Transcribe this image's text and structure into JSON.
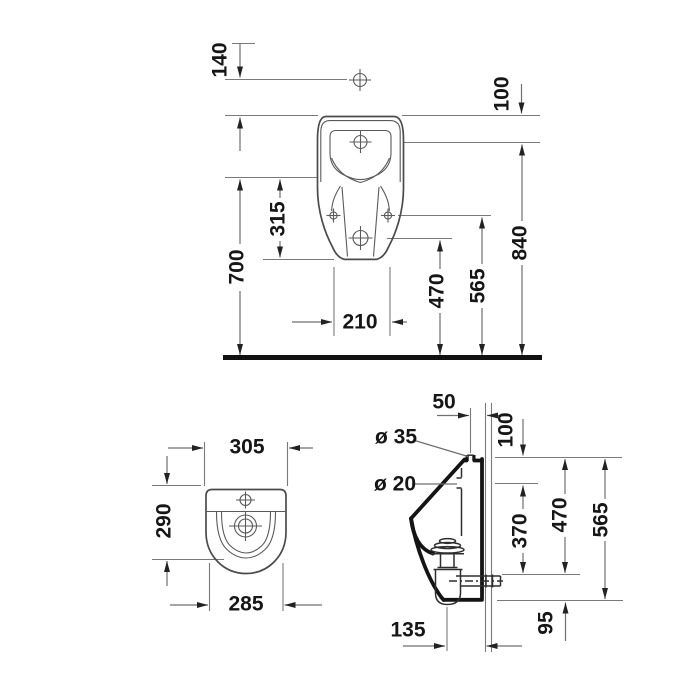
{
  "front_view": {
    "dim_140": "140",
    "dim_100": "100",
    "dim_700": "700",
    "dim_315": "315",
    "dim_210": "210",
    "dim_470": "470",
    "dim_565": "565",
    "dim_840": "840"
  },
  "top_view": {
    "dim_305": "305",
    "dim_290": "290",
    "dim_285": "285"
  },
  "side_view": {
    "dim_50": "50",
    "dia_35": "ø 35",
    "dia_20": "ø 20",
    "dim_100": "100",
    "dim_370": "370",
    "dim_470": "470",
    "dim_565": "565",
    "dim_95": "95",
    "dim_135": "135"
  },
  "colors": {
    "background": "#ffffff",
    "line": "#6f6f6f",
    "outline": "#4b4b4b",
    "heavy_line": "#141414",
    "text": "#161616"
  }
}
